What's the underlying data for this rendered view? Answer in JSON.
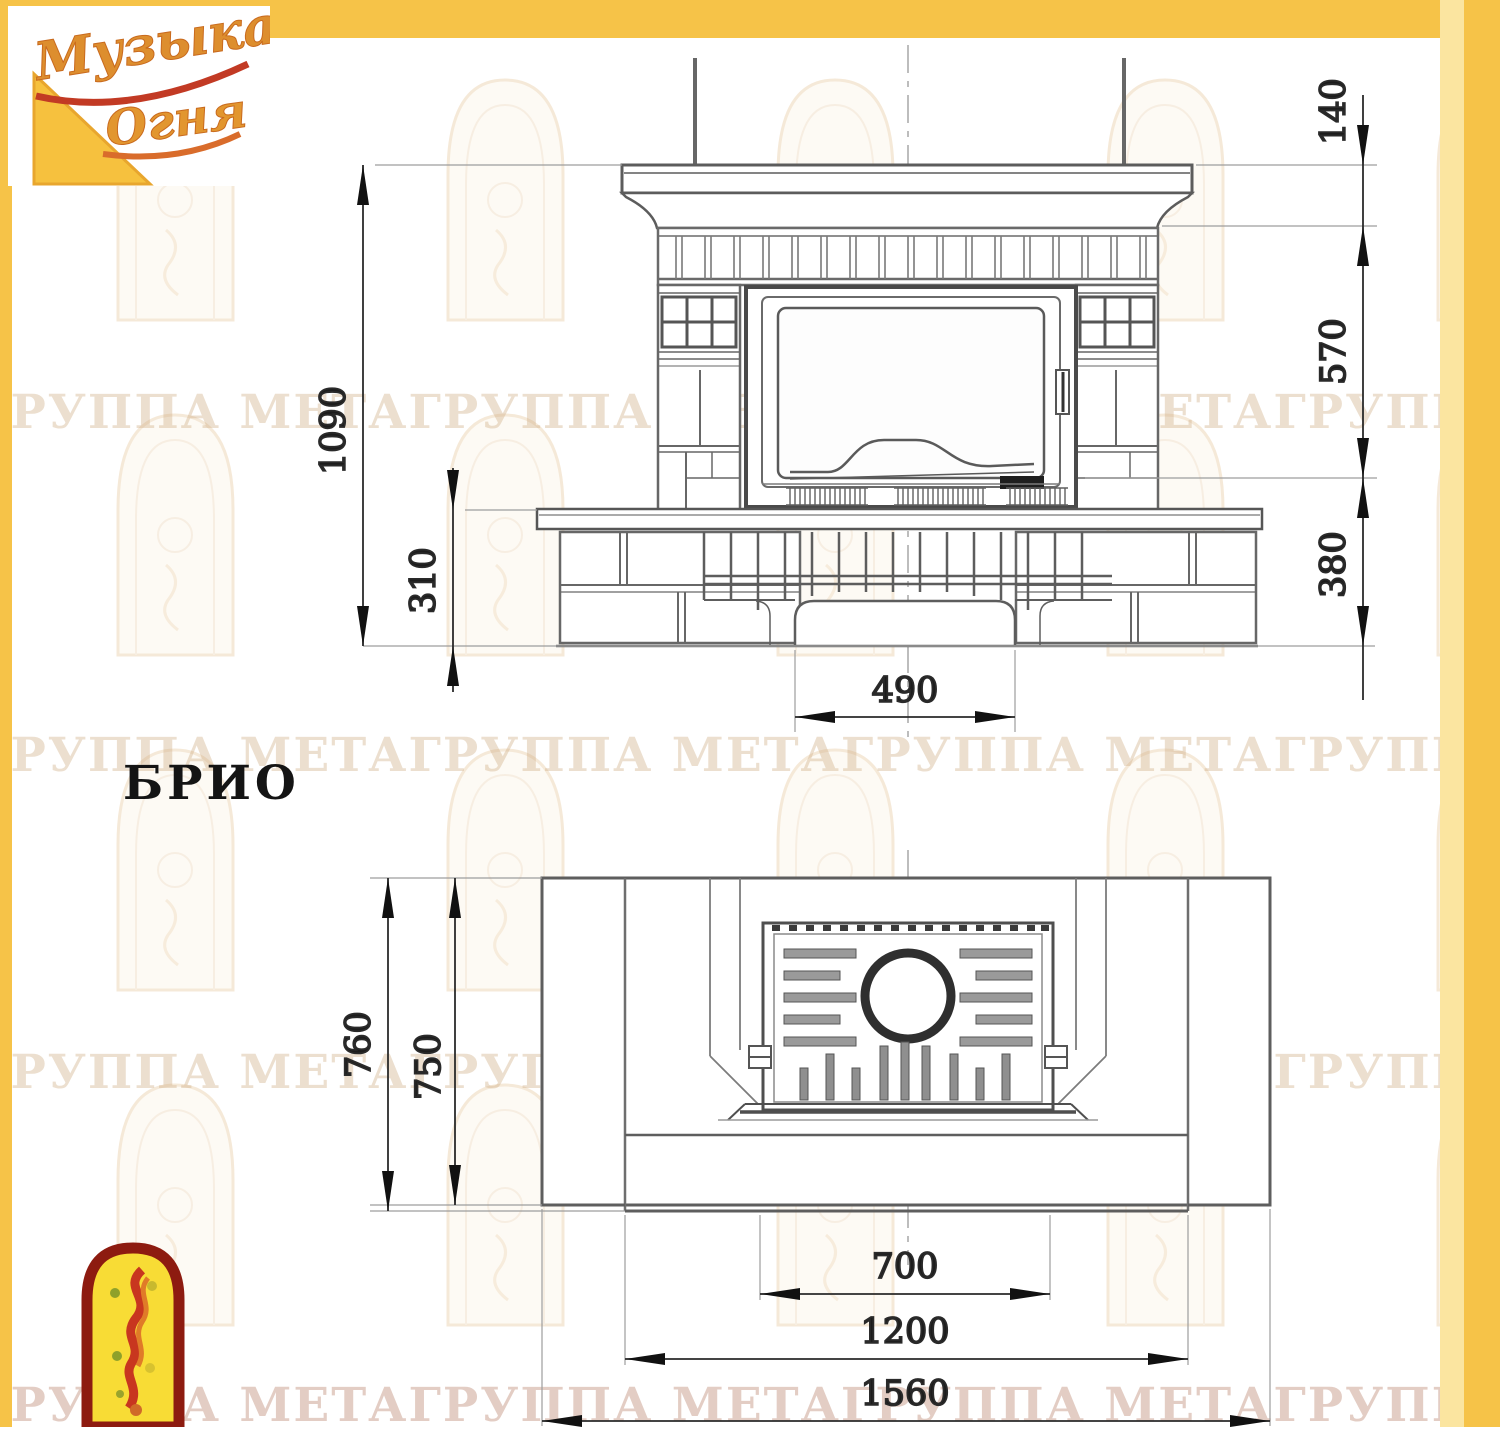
{
  "page": {
    "model_label": "БРИО"
  },
  "brand": {
    "logo_line1": "Музыка",
    "logo_line2": "Огня",
    "colors": {
      "frame_gold": "#f6c348",
      "frame_pale": "#fbe5a0",
      "logo_red": "#8d1b10",
      "logo_yellow": "#f8dc35"
    }
  },
  "watermark": {
    "text": "ГРУППА МЕТАГРУППА МЕТАГРУППА МЕТАГРУППА МЕТА ГРУППА МЕТА"
  },
  "front_view": {
    "dims": {
      "height_total": "1090",
      "plinth_height": "310",
      "cap_height": "140",
      "body_height": "570",
      "base_height": "380",
      "niche_width": "490"
    }
  },
  "plan_view": {
    "dims": {
      "depth_total": "760",
      "depth_body": "750",
      "firebox_width": "700",
      "hearth_width": "1200",
      "width_total": "1560"
    }
  }
}
